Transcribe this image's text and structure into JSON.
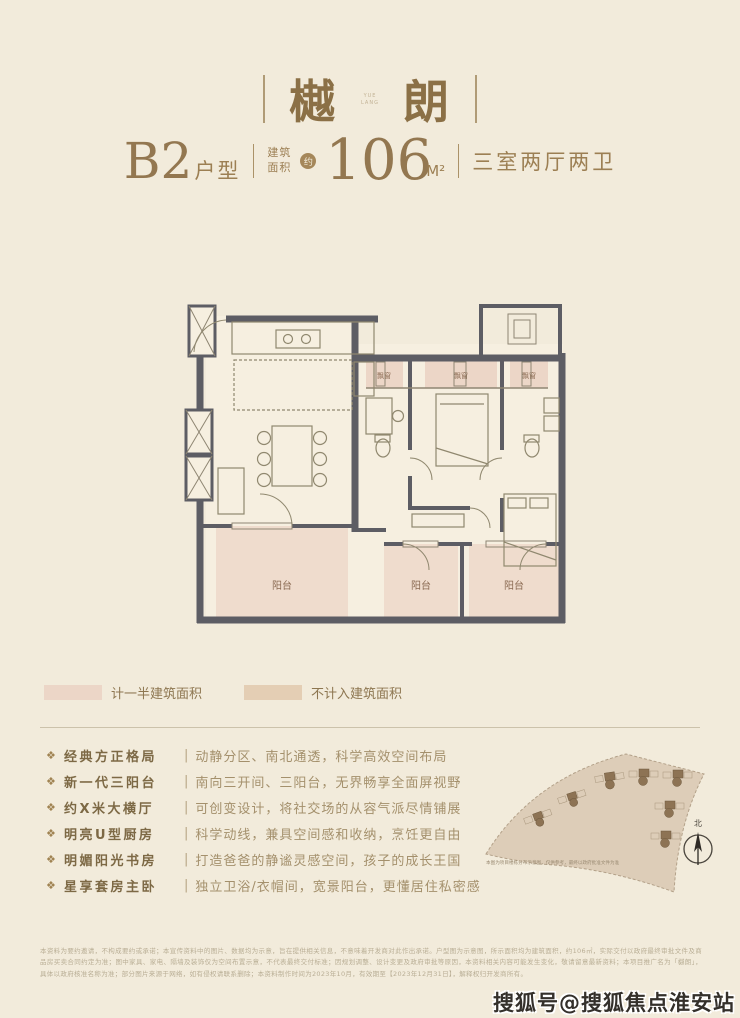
{
  "colors": {
    "background": "#f2ebdb",
    "title_brown": "#8b7046",
    "gold_text": "#9c7f53",
    "wall_gray": "#5d5d64",
    "pink_area": "#ecd6c7",
    "tan_area": "#e4ceb4"
  },
  "header": {
    "title_char_left": "樾",
    "title_char_right": "朗",
    "title_mark_top": "YUE",
    "title_mark_bottom": "LANG"
  },
  "spec": {
    "unit_big": "B2",
    "unit_small": "户型",
    "area_prefix_line1": "建筑",
    "area_prefix_line2": "面积",
    "approx_badge": "约",
    "area_value": "106",
    "area_unit": "M²",
    "rooms": "三室两厅两卫"
  },
  "floor_plan": {
    "bay_window_label": "飘窗",
    "balcony_label": "阳台"
  },
  "legend": {
    "items": [
      {
        "label": "计一半建筑面积",
        "color": "#ecd6c7"
      },
      {
        "label": "不计入建筑面积",
        "color": "#e4ceb4"
      }
    ]
  },
  "features": {
    "bullet": "❖",
    "separator": "|",
    "items": [
      {
        "title": "经典方正格局",
        "desc": "动静分区、南北通透，科学高效空间布局"
      },
      {
        "title": "新一代三阳台",
        "desc": "南向三开间、三阳台，无界畅享全面屏视野"
      },
      {
        "title": "约X米大横厅",
        "desc": "可创变设计，将社交场的从容气派尽情铺展"
      },
      {
        "title": "明亮U型厨房",
        "desc": "科学动线，兼具空间感和收纳，烹饪更自由"
      },
      {
        "title": "明媚阳光书房",
        "desc": "打造爸爸的静谧灵感空间，孩子的成长王国"
      },
      {
        "title": "星享套房主卧",
        "desc": "独立卫浴/衣帽间，宽景阳台，更懂居住私密感"
      }
    ]
  },
  "site_plan": {
    "caption": "本图为项目楼栋分布示意图，仅供参考，最终以政府批准文件为准",
    "north_label": "北"
  },
  "disclaimer": {
    "text": "本资料为要约邀请，不构成要约或承诺；本宣传资料中的图片、数据均为示意，旨在提供相关信息，不意味着开发商对此作出承诺。户型图为示意图，所示面积均为建筑面积，约106㎡，实际交付以政府最终审批文件及商品房买卖合同约定为准；图中家具、家电、隔墙及装饰仅为空间布置示意，不代表最终交付标准；因规划调整、设计变更及政府审批等原因，本资料相关内容可能发生变化，敬请留意最新资料；本项目推广名为「樾朗」，具体以政府核准名称为准；部分图片来源于网络，如有侵权请联系删除；本资料制作时间为2023年10月，有效期至【2023年12月31日】，解释权归开发商所有。"
  },
  "watermark": {
    "text": "搜狐号@搜狐焦点淮安站"
  }
}
